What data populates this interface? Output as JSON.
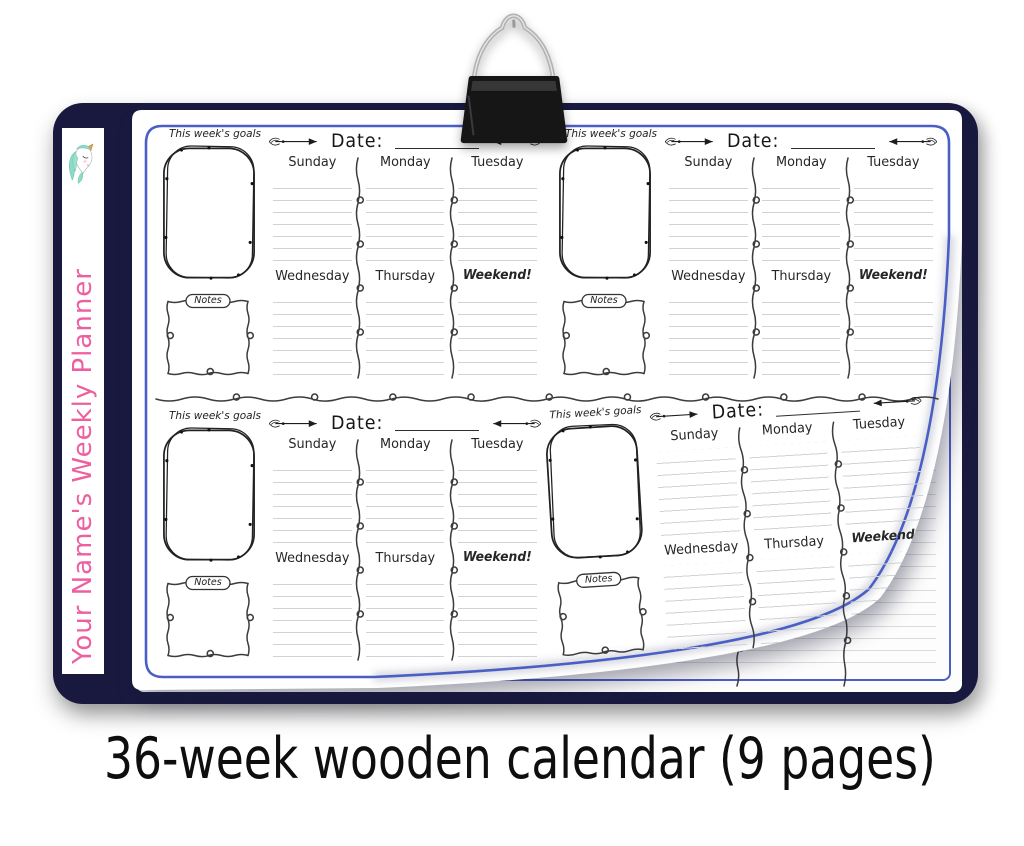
{
  "sidebar": {
    "brand_text": "Your Name's Weekly Planner",
    "brand_color": "#ee5fa0",
    "logo_icon": "unicorn-icon"
  },
  "clip_icon": "binder-clip",
  "planner": {
    "goals_label": "This week's goals",
    "notes_label": "Notes",
    "date_label": "Date:",
    "days_row1": [
      "Sunday",
      "Monday",
      "Tuesday"
    ],
    "days_row2": [
      "Wednesday",
      "Thursday",
      "Weekend!"
    ],
    "sections_visible": 4,
    "icons": {
      "left_arrow": "arrow-right-icon",
      "right_arrow": "arrow-left-icon",
      "column_divider": "squiggle-divider-icon",
      "half_divider": "garland-divider-icon"
    }
  },
  "caption": {
    "text": "36-week wooden calendar (9 pages)"
  },
  "colors": {
    "board_navy": "#191940",
    "page_border_blue": "#4a5fc6",
    "brand_pink": "#ee5fa0",
    "ruled_line_gray": "#cfd2d6",
    "doodle_ink": "#3c3c3c"
  }
}
